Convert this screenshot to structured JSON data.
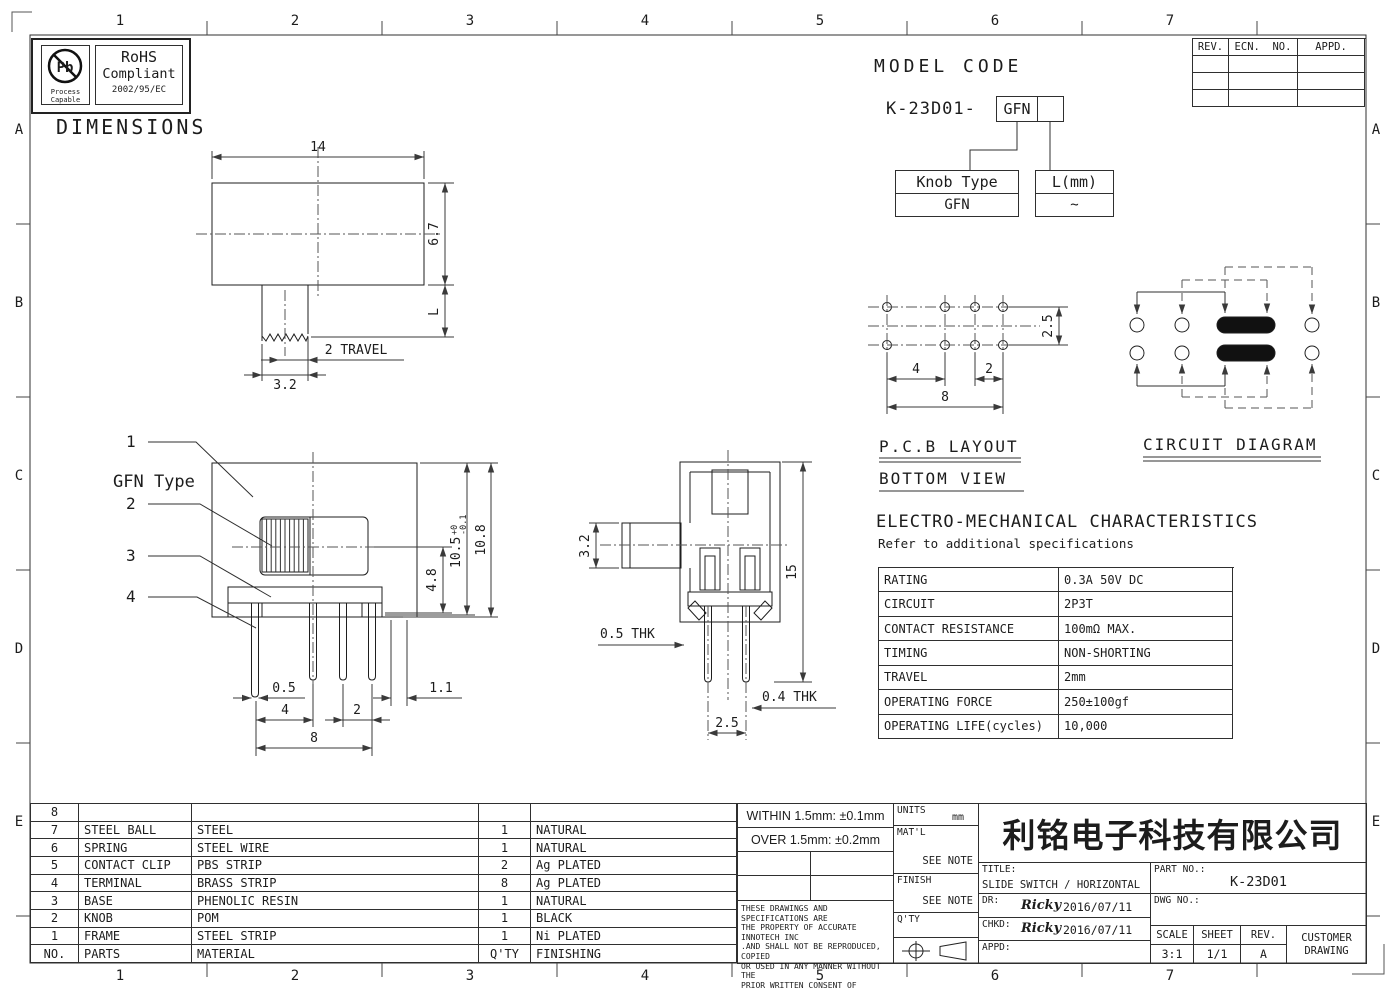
{
  "border": {
    "cols": [
      "1",
      "2",
      "3",
      "4",
      "5",
      "6",
      "7"
    ],
    "rows": [
      "A",
      "B",
      "C",
      "D",
      "E"
    ]
  },
  "badge": {
    "pb": "Pb",
    "process": "Process",
    "capable": "Capable",
    "rohs": "RoHS",
    "compliant": "Compliant",
    "directive": "2002/95/EC"
  },
  "headings": {
    "dimensions": "DIMENSIONS",
    "model_code": "MODEL CODE",
    "pcb_layout": "P.C.B LAYOUT",
    "bottom_view": "BOTTOM VIEW",
    "circuit_diagram": "CIRCUIT DIAGRAM",
    "em_title": "ELECTRO-MECHANICAL CHARACTERISTICS",
    "em_subtitle": "Refer to additional specifications"
  },
  "model_code": {
    "prefix": "K-23D01-",
    "code_box": "GFN",
    "knob_type_label": "Knob Type",
    "knob_type_value": "GFN",
    "length_label": "L(mm)",
    "length_value": "~"
  },
  "rev_table": {
    "rev": "REV.",
    "ecn_no": "ECN.  NO.",
    "appd": "APPD."
  },
  "top_view": {
    "width": "14",
    "height": "6.7",
    "length": "L",
    "travel": "2 TRAVEL",
    "stem_width": "3.2"
  },
  "front_view": {
    "type_label": "GFN Type",
    "callout_1": "1",
    "callout_2": "2",
    "callout_3": "3",
    "callout_4": "4",
    "dim_height_inner": "10.5",
    "tol_upper": "+0",
    "tol_lower": "-0.1",
    "dim_height_outer": "10.8",
    "dim_knob_to_base": "4.8",
    "dim_pin_width": "0.5",
    "dim_pitch_a": "4",
    "dim_pitch_b": "2",
    "dim_span": "8",
    "dim_offset": "1.1"
  },
  "side_view": {
    "dim_knob_height": "3.2",
    "dim_total_height": "15",
    "dim_frame_thk": "0.5 THK",
    "dim_pin_thk": "0.4 THK",
    "dim_row_pitch": "2.5"
  },
  "pcb_view": {
    "dim_row_pitch": "2.5",
    "dim_pitch_a": "4",
    "dim_pitch_b": "2",
    "dim_span": "8"
  },
  "em_table": {
    "rows": [
      {
        "label": "RATING",
        "value": "0.3A 50V DC"
      },
      {
        "label": "CIRCUIT",
        "value": "2P3T"
      },
      {
        "label": "CONTACT RESISTANCE",
        "value": "100mΩ MAX."
      },
      {
        "label": "TIMING",
        "value": "NON-SHORTING"
      },
      {
        "label": "TRAVEL",
        "value": "2mm"
      },
      {
        "label": "OPERATING FORCE",
        "value": "250±100gf"
      },
      {
        "label": "OPERATING LIFE(cycles)",
        "value": "10,000"
      }
    ]
  },
  "parts_table": {
    "columns": {
      "no": "NO.",
      "parts": "PARTS",
      "material": "MATERIAL",
      "qty": "Q'TY",
      "finishing": "FINISHING"
    },
    "rows": [
      {
        "no": "8",
        "parts": "",
        "material": "",
        "qty": "",
        "finishing": ""
      },
      {
        "no": "7",
        "parts": "STEEL BALL",
        "material": "STEEL",
        "qty": "1",
        "finishing": "NATURAL"
      },
      {
        "no": "6",
        "parts": "SPRING",
        "material": "STEEL WIRE",
        "qty": "1",
        "finishing": "NATURAL"
      },
      {
        "no": "5",
        "parts": "CONTACT CLIP",
        "material": "PBS STRIP",
        "qty": "2",
        "finishing": "Ag PLATED"
      },
      {
        "no": "4",
        "parts": "TERMINAL",
        "material": "BRASS STRIP",
        "qty": "8",
        "finishing": "Ag PLATED"
      },
      {
        "no": "3",
        "parts": "BASE",
        "material": "PHENOLIC RESIN",
        "qty": "1",
        "finishing": "NATURAL"
      },
      {
        "no": "2",
        "parts": "KNOB",
        "material": "POM",
        "qty": "1",
        "finishing": "BLACK"
      },
      {
        "no": "1",
        "parts": "FRAME",
        "material": "STEEL STRIP",
        "qty": "1",
        "finishing": "Ni PLATED"
      }
    ]
  },
  "title_block": {
    "tolerance_within": "WITHIN 1.5mm: ±0.1mm",
    "tolerance_over": "OVER 1.5mm: ±0.2mm",
    "legal": "THESE DRAWINGS AND SPECIFICATIONS ARE\nTHE PROPERTY OF ACCURATE INNOTECH INC\n.AND SHALL NOT BE REPRODUCED, COPIED\nOR USED IN ANY MANNER WITHOUT THE\nPRIOR WRITTEN CONSENT OF  ACCURATE\nINNOTECH INC.",
    "units_label": "UNITS",
    "units_value": "mm",
    "matl_label": "MAT'L",
    "matl_value": "SEE NOTE",
    "finish_label": "FINISH",
    "finish_value": "SEE NOTE",
    "qty_label": "Q'TY",
    "company": "利铭电子科技有限公司",
    "title_label": "TITLE:",
    "title_value": "SLIDE SWITCH / HORIZONTAL",
    "part_no_label": "PART NO.:",
    "part_no_value": "K-23D01",
    "dwg_no_label": "DWG NO.:",
    "dr_label": "DR:",
    "dr_sign": "Ricky",
    "dr_date": "2016/07/11",
    "chkd_label": "CHKD:",
    "chkd_sign": "Ricky",
    "chkd_date": "2016/07/11",
    "appd_label": "APPD:",
    "scale_label": "SCALE",
    "scale_value": "3:1",
    "sheet_label": "SHEET",
    "sheet_value": "1/1",
    "rev_label": "REV.",
    "rev_value": "A",
    "customer": "CUSTOMER\nDRAWING"
  }
}
